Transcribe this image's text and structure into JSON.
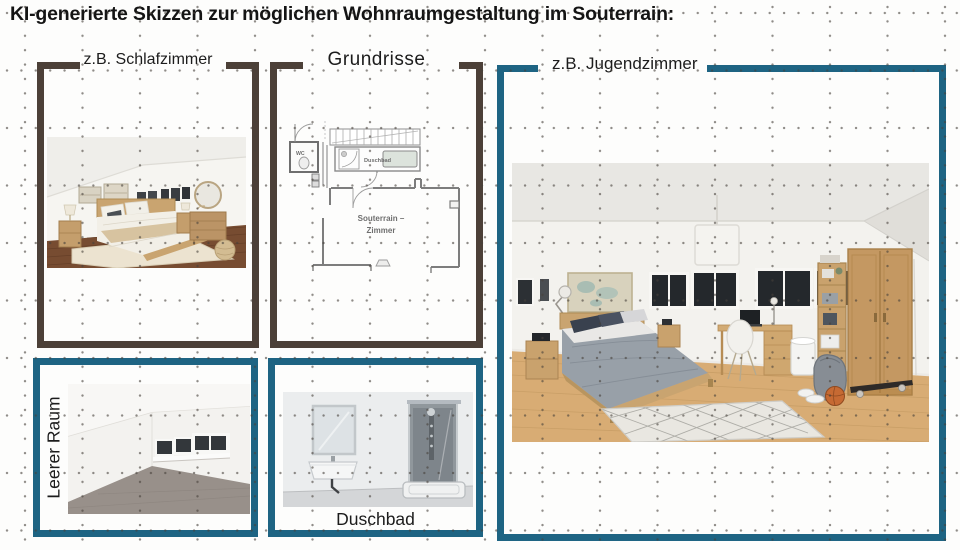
{
  "title": "KI-generierte Skizzen zur möglichen Wohnraumgestaltung im Souterrain:",
  "colors": {
    "frame_brown": "#4c4038",
    "frame_teal": "#1e6483",
    "grid_dot": "#46403a"
  },
  "panels": {
    "schlafzimmer": {
      "label": "z.B. Schlafzimmer"
    },
    "grundrisse": {
      "label": "Grundrisse",
      "plan_labels": {
        "wc": "WC",
        "bath": "Duschbad",
        "room_line1": "Souterrain –",
        "room_line2": "Zimmer"
      }
    },
    "jugendzimmer": {
      "label": "z.B. Jugendzimmer"
    },
    "leerer_raum": {
      "label": "Leerer Raum"
    },
    "duschbad": {
      "label": "Duschbad"
    }
  }
}
